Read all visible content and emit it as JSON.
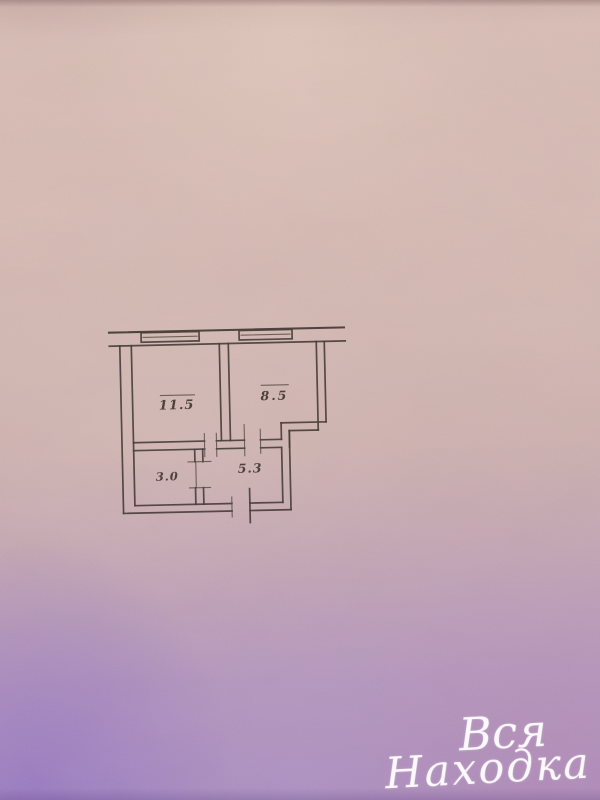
{
  "floor_plan": {
    "rooms": [
      {
        "label": "11.5",
        "overline": true,
        "kind": "room"
      },
      {
        "label": "8.5",
        "overline": true,
        "kind": "room"
      },
      {
        "label": "3.0",
        "overline": false,
        "kind": "room"
      },
      {
        "label": "5.3",
        "overline": false,
        "kind": "room"
      }
    ],
    "features": {
      "windows": 2,
      "interior_door_openings": 3,
      "entrance_door_openings": 1
    }
  },
  "watermark": {
    "line1": "Вся",
    "line2": "Находка",
    "color": "#ffffff"
  },
  "colors": {
    "wall_ink": "#3e332c",
    "label_ink": "#3a2e26",
    "paper_top": "#d6bab1",
    "paper_bottom": "#a98cc0"
  }
}
